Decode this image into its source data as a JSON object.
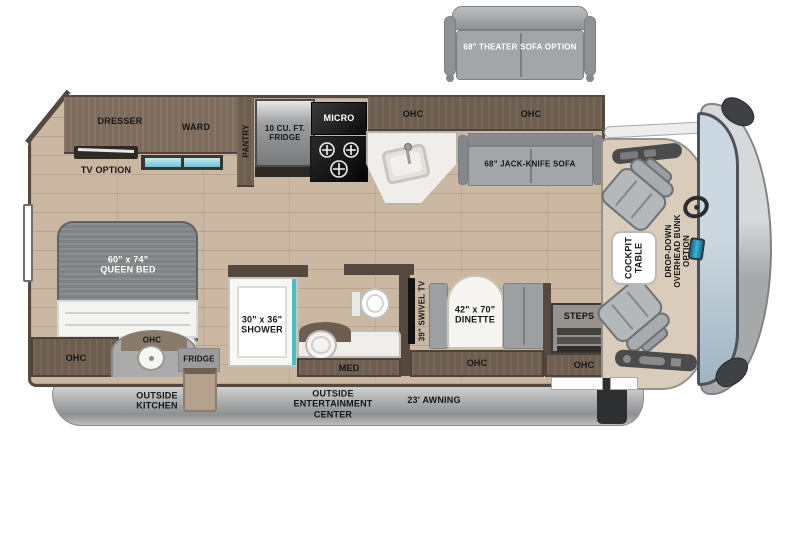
{
  "plan": {
    "type": "rv-floorplan",
    "colors": {
      "floor_wood": "#cbb8a2",
      "cabinet_brown": "#6e5e50",
      "wall_dark": "#55493f",
      "sofa_gray": "#a2a6a8",
      "window_teal": "#79cbdc",
      "shower_teal": "#45c0c6",
      "counter_white": "#f2f1ed",
      "skirt_gray": "#a7a8aa",
      "windshield_blue": "#b9c9d6"
    }
  },
  "labels": {
    "theater_sofa": "68\" THEATER SOFA OPTION",
    "dresser": "DRESSER",
    "ward": "WARD",
    "pantry": "PANTRY",
    "tv_option": "TV OPTION",
    "fridge_10": "10 CU. FT.\nFRIDGE",
    "micro": "MICRO",
    "ohc_kitchen": "OHC",
    "ohc_sofa": "OHC",
    "jackknife_sofa": "68\" JACK-KNIFE SOFA",
    "queen_bed": "60\" x 74\"\nQUEEN BED",
    "ohc_bedroom": "OHC",
    "ohc_outside_kitchen": "OHC",
    "fridge_outside": "FRIDGE",
    "outside_kitchen": "OUTSIDE\nKITCHEN",
    "shower": "30\" x 36\"\nSHOWER",
    "med": "MED",
    "swivel_tv": "39\" SWIVEL TV",
    "dinette": "42\" x 70\"\nDINETTE",
    "ohc_dinette": "OHC",
    "steps": "STEPS",
    "ohc_entry": "OHC",
    "cockpit_table": "COCKPIT\nTABLE",
    "bunk_option": "DROP-DOWN\nOVERHEAD BUNK\nOPTION",
    "outside_entertainment": "OUTSIDE\nENTERTAINMENT\nCENTER",
    "awning": "23' AWNING"
  }
}
